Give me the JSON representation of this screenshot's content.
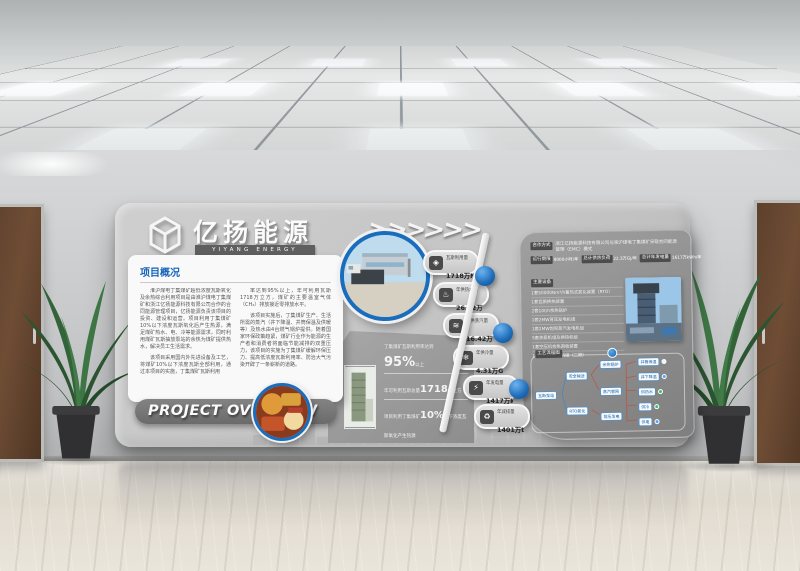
{
  "brand": {
    "name_cn": "亿扬能源",
    "name_en": "YIYANG ENERGY"
  },
  "overview": {
    "heading": "项目概况",
    "paragraphs": [
      "淮沪煤电丁集煤矿超低浓度瓦斯氧化及余热综合利用项目是由淮沪煤电丁集煤矿和浙江亿扬能源科技有限公司合作的合同能源管理项目，亿扬能源负责该项目的投资、建设和运营。项目利用丁集煤矿10%以下浓度瓦斯氧化后产生热源，满足煤矿热水、电、冷等能源需求，同时利用煤矿瓦斯抽放泵站的余热为煤矿提供热水，解决员工生活需求。",
      "该项目采用国内外先进设备及工艺，将煤矿10%以下浓度瓦斯全部利用，通过本项目的实施，丁集煤矿瓦斯利用",
      "率达到95%以上，年可利用瓦斯1718万立方，煤矿的主要温室气体（CH₄）排放接近零排放水平。",
      "该项目实施后，丁集煤矿生产、生活所需的蒸汽（井下降温、井筒保温及供暖等）及热水由4台燃气锅炉提供。随着国家环保政策趋紧，煤矿行业作为能源的生产者和消费者将面临节能减排的双重压力，该项目的实施为丁集煤矿缓解环保压力、提高低浓度瓦斯利用率、防治大气污染开辟了一条崭新的道路。"
    ]
  },
  "banner": {
    "text": "PROJECT OVERVIEW"
  },
  "badges": [
    {
      "icon_name": "gas-icon",
      "glyph": "◈",
      "label": "瓦斯利用量",
      "value": "1718万Nm³"
    },
    {
      "icon_name": "hot-water-icon",
      "glyph": "♨",
      "label": "年供热水量",
      "value": "26.22万GJ"
    },
    {
      "icon_name": "steam-icon",
      "glyph": "≋",
      "label": "年供蒸汽量",
      "value": "16.42万GJ"
    },
    {
      "icon_name": "cooling-icon",
      "glyph": "❄",
      "label": "年供冷量",
      "value": "4.31万GJ"
    },
    {
      "icon_name": "power-icon",
      "glyph": "⚡",
      "label": "年发电量",
      "value": "1417万kWh"
    },
    {
      "icon_name": "emission-icon",
      "glyph": "♻",
      "label": "年减排量",
      "value": "1401万t"
    }
  ],
  "highlight": {
    "line1_prefix": "丁集煤矿瓦斯利用率达到",
    "line1_value": "95%",
    "line1_suffix": "以上",
    "line2_prefix": "年可利用瓦斯总量",
    "line2_value": "1718",
    "line2_suffix": "万立方",
    "line3_prefix": "项目利用丁集煤矿",
    "line3_value": "10%",
    "line3_suffix": "以下浓度瓦斯氧化产生热源"
  },
  "panel": {
    "coop_label": "合作方式",
    "coop_value": "浙江亿扬能源科技有限公司与淮沪煤电丁集煤矿采取合同能源管理（EMC）模式",
    "terms": [
      {
        "label": "运行期限",
        "value": "8000小时/年"
      },
      {
        "label": "总计供热负荷",
        "value": "22.3万GJ/年"
      },
      {
        "label": "总计年发电量",
        "value": "1617万kWh/年"
      }
    ],
    "equipment_label": "主要设备",
    "equipment": [
      "1套50000Nm³/h蓄热式氧化装置（RTO）",
      "1套瓦斯换热装置",
      "2套10t/h余热锅炉",
      "1套2MW背压发电机组",
      "1套2MW饱和蒸汽发电机组",
      "5套热泵机组及换热机组",
      "1套空压机余热回收装置",
      "1套溴化锂制冷机组（二期）"
    ],
    "flow": {
      "title": "工艺流程图",
      "nodes": [
        "瓦斯泵站",
        "安全输送",
        "RTO氧化",
        "余热锅炉",
        "蒸汽管网",
        "背压发电"
      ],
      "outputs": [
        {
          "label": "井筒保温",
          "color": "#f2f2f2"
        },
        {
          "label": "井下降温",
          "color": "#4da3ff"
        },
        {
          "label": "供热水",
          "color": "#38c172"
        },
        {
          "label": "供冷",
          "color": "#38c172"
        },
        {
          "label": "供电",
          "color": "#4da3ff"
        }
      ]
    }
  },
  "colors": {
    "accent_blue": "#1d72c2",
    "ring_blue": "#1565b8"
  }
}
